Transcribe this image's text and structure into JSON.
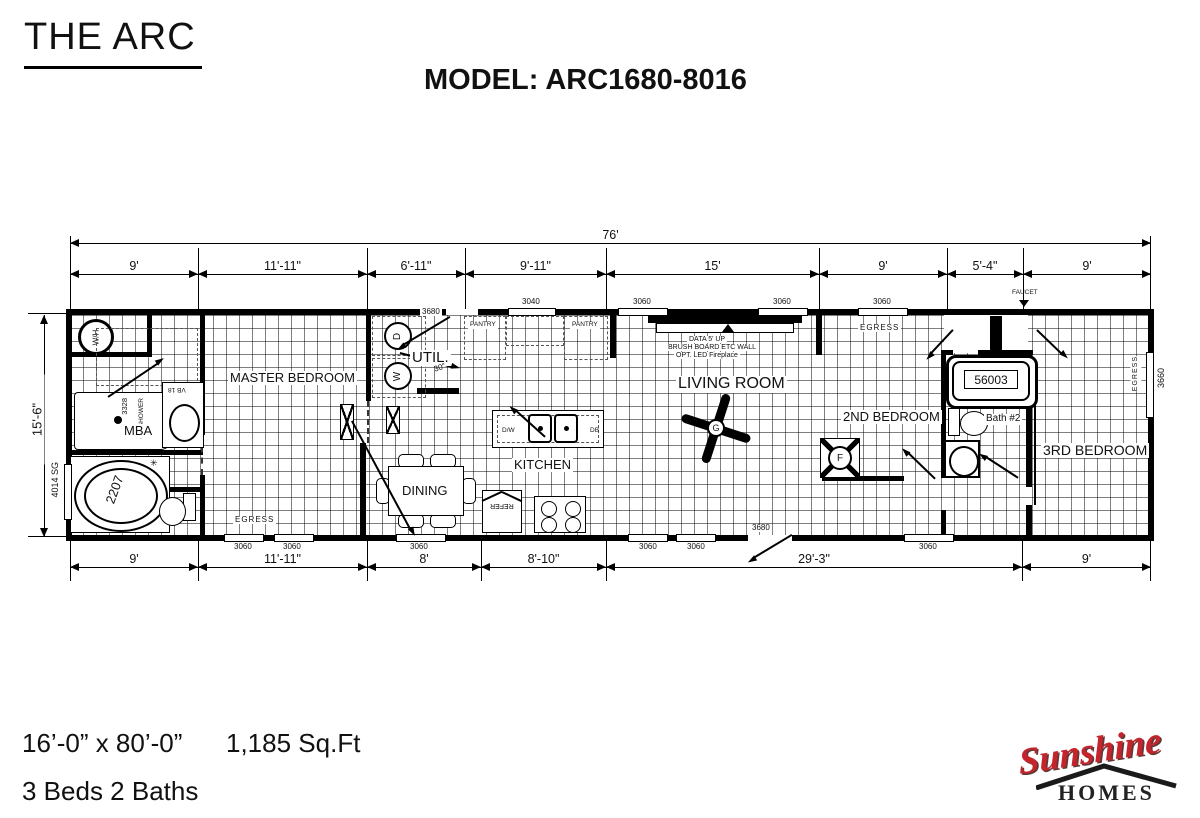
{
  "header": {
    "title": "THE ARC",
    "model": "MODEL: ARC1680-8016"
  },
  "footer": {
    "size": "16’-0” x 80’-0”",
    "sqft": "1,185 Sq.Ft",
    "beds": "3 Beds 2 Baths"
  },
  "logo": {
    "brand": "Sunshine",
    "sub": "HOMES",
    "brand_color": "#c5242c"
  },
  "plan": {
    "overall_width": "76'",
    "overall_height": "15'-6\"",
    "top_dims": [
      "9'",
      "11'-11\"",
      "6'-11\"",
      "9'-11\"",
      "15'",
      "9'",
      "5'-4\"",
      "9'"
    ],
    "bottom_dims": [
      "9'",
      "11'-11\"",
      "8'",
      "8'-10\"",
      "29'-3\"",
      "9'"
    ],
    "rooms": {
      "master": "MASTER BEDROOM",
      "mba": "MBA",
      "util": "UTIL.",
      "kitchen": "KITCHEN",
      "dining": "DINING",
      "living": "LIVING ROOM",
      "bed2": "2ND BEDROOM",
      "bath2": "Bath #2",
      "bed3": "3RD BEDROOM"
    },
    "fixtures": {
      "water_heater": "W/H",
      "dryer": "D",
      "washer": "W",
      "pantry": "PANTRY",
      "dw": "D/W",
      "db": "DB",
      "refer": "REFER",
      "fan": "G",
      "furnace": "F",
      "garden_tub": "2207",
      "tub_window": "4014 SG",
      "shower": "60\" SHOWER",
      "shower_size": "3328",
      "vanity": "VB 18",
      "bath2_tub": "56003",
      "door30": "30\"",
      "faucet": "FAUCET"
    },
    "windows": {
      "w3040": "3040",
      "w3060": "3060",
      "w3660": "3660",
      "w3680": "3680"
    },
    "notes": {
      "egress": "EGRESS",
      "wall1": "DATA 5' UP",
      "wall2": "BRUSH BOARD ETC WALL",
      "wall3": "OPT. LED Fireplace"
    }
  }
}
